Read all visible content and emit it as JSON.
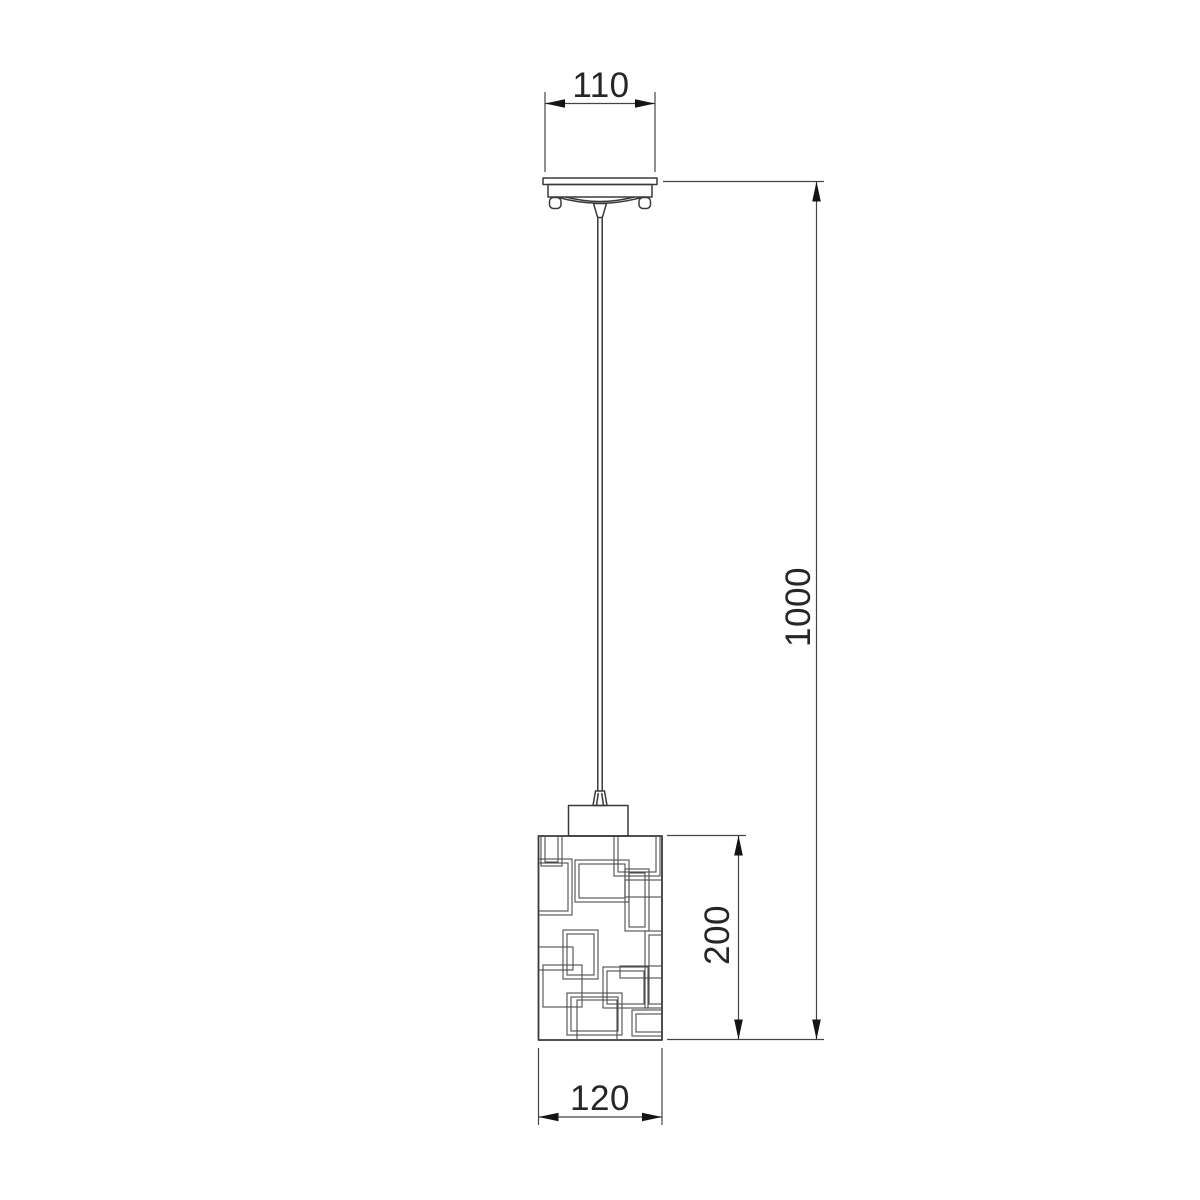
{
  "drawing": {
    "background": "#ffffff",
    "line_color": "#3a3a3a",
    "pattern_color": "#4d4d4d",
    "dim_line_color": "#454545",
    "arrow_color": "#141414",
    "text_color": "#262626",
    "dimensions": {
      "canopy_width": {
        "label": "110",
        "value_mm": 110
      },
      "overall_height": {
        "label": "1000",
        "value_mm": 1000
      },
      "shade_height": {
        "label": "200",
        "value_mm": 200
      },
      "shade_width": {
        "label": "120",
        "value_mm": 120
      }
    }
  }
}
